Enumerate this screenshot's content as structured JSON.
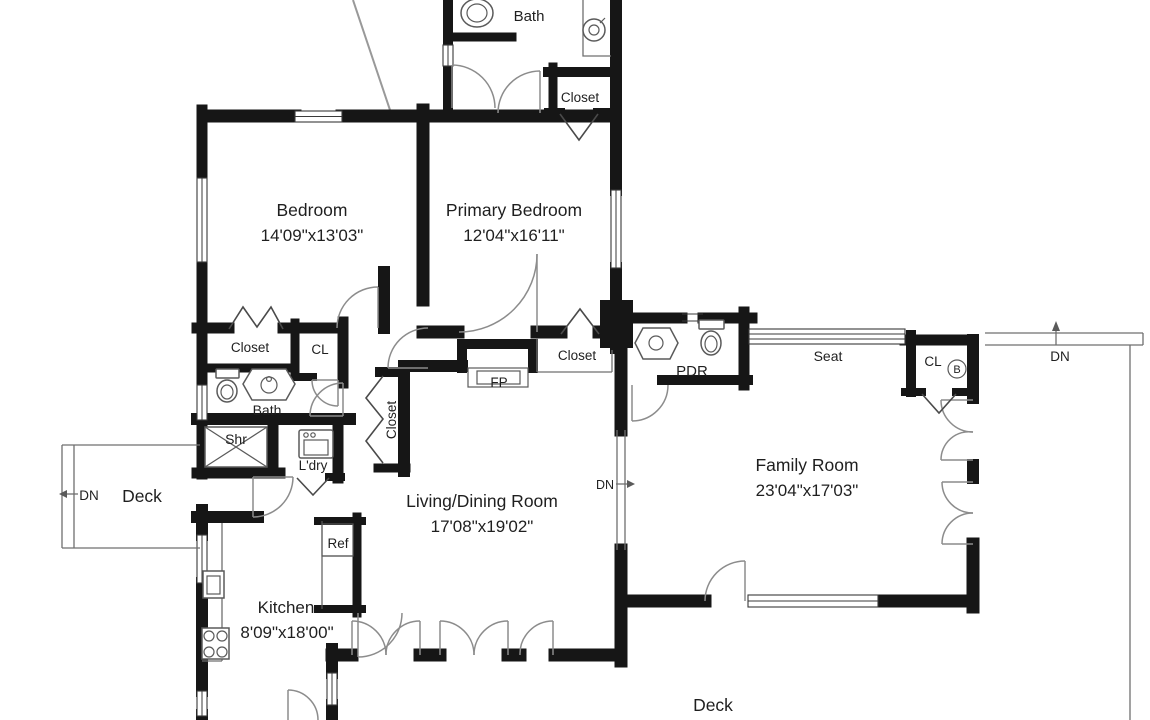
{
  "floorplan": {
    "colors": {
      "wall": "#161616",
      "door": "#8c8c8c",
      "ink": "#1f1f1f",
      "thin": "#5a5a5a",
      "bg": "#ffffff"
    },
    "rooms": {
      "bedroom": {
        "name": "Bedroom",
        "dims": "14'09\"x13'03\""
      },
      "primary_bedroom": {
        "name": "Primary Bedroom",
        "dims": "12'04\"x16'11\""
      },
      "living_dining": {
        "name": "Living/Dining Room",
        "dims": "17'08\"x19'02\""
      },
      "family_room": {
        "name": "Family Room",
        "dims": "23'04\"x17'03\""
      },
      "kitchen": {
        "name": "Kitchen",
        "dims": "8'09\"x18'00\""
      },
      "bath_upper": {
        "name": "Bath"
      },
      "bath_hall": {
        "name": "Bath"
      },
      "powder_room": {
        "name": "PDR"
      },
      "laundry": {
        "name": "L'dry"
      },
      "shower": {
        "name": "Shr"
      }
    },
    "closets": {
      "upper": "Closet",
      "bedroom": "Closet",
      "hall_cl": "CL",
      "hall_tall": "Closet",
      "primary_lower": "Closet",
      "family_cl": "CL",
      "family_cl_note": "B"
    },
    "features": {
      "fireplace": "FP",
      "seat": "Seat",
      "fridge": "Ref"
    },
    "decks": {
      "left": "Deck",
      "bottom": "Deck"
    },
    "stairs": {
      "dn_left": "DN",
      "dn_living": "DN",
      "dn_right": "DN"
    }
  }
}
